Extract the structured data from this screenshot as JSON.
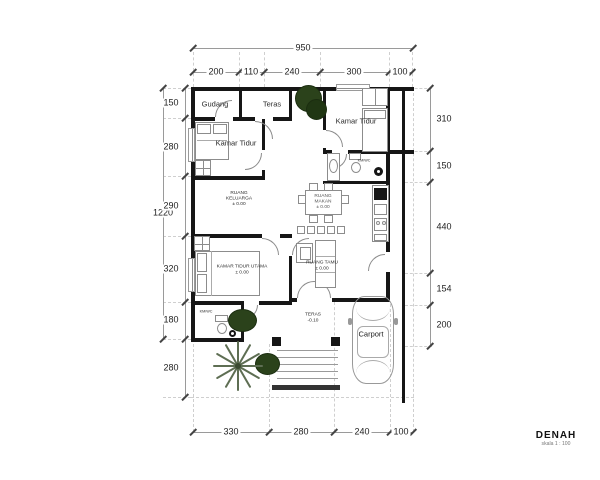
{
  "title": {
    "name": "DENAH",
    "scale": "skala 1 : 100"
  },
  "dims": {
    "top_total": "950",
    "top": [
      "200",
      "110",
      "240",
      "300",
      "100"
    ],
    "left_total": "1220",
    "left": [
      "150",
      "280",
      "290",
      "320",
      "180",
      "280"
    ],
    "right": [
      "310",
      "150",
      "440",
      "154",
      "200"
    ],
    "bottom": [
      "330",
      "280",
      "240",
      "100"
    ]
  },
  "rooms": {
    "gudang": "Gudang",
    "teras_top": "Teras",
    "kamar_tidur_left": "Kamar Tidur",
    "kamar_tidur_right": "Kamar Tidur",
    "kmwc_top": "KM/WC",
    "ruang_keluarga": {
      "line1": "RUANG",
      "line2": "KELUARGA",
      "elev": "± 0.00"
    },
    "ruang_makan": {
      "line1": "RUANG",
      "line2": "MAKAN",
      "elev": "± 0.00"
    },
    "kamar_tidur_utama": {
      "name": "KAMAR TIDUR UTAMA",
      "elev": "± 0.00"
    },
    "ruang_tamu": {
      "name": "RUANG TAMU",
      "elev": "± 0.00"
    },
    "kmwc_bottom": "KM/WC",
    "teras_bottom": {
      "name": "TERAS",
      "elev": "-0.10"
    },
    "carport": "Carport"
  },
  "colors": {
    "wall": "#161616",
    "tree": "#2b421b",
    "palm": "#5e6e53",
    "dim_line": "#9a9a9a",
    "text": "#1e1e1e"
  }
}
